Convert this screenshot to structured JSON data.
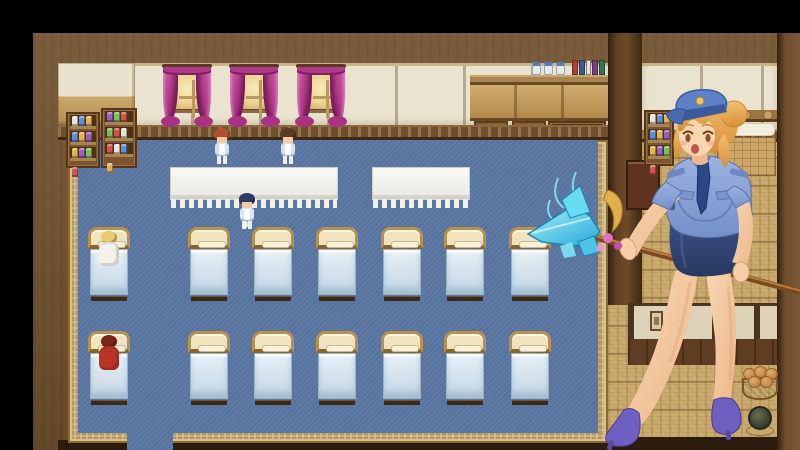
{
  "scene": {
    "title": "dormitory-interior-game-scene",
    "palette": {
      "carpet": "#5a76a2",
      "carpet_border": "#b7985c",
      "tatami": "#c9a96b",
      "curtain": "#c6429c",
      "wall_cream": "#eae3cf",
      "wall_frame": "#71512e",
      "bed_frame": "#b8914f",
      "mattress": "#dcebf4",
      "crystal": "#49cdec",
      "uniform_blue": "#8ca6d8",
      "skirt_navy": "#2e4070",
      "hair_blonde": "#eaaa55"
    },
    "main_room": {
      "windows_x": [
        165,
        232,
        299
      ],
      "tables": [
        {
          "x": 170,
          "y": 167,
          "w": 168,
          "h": 33
        },
        {
          "x": 372,
          "y": 167,
          "w": 98,
          "h": 33
        }
      ],
      "beds": {
        "columns_x": [
          88,
          188,
          252,
          316,
          381,
          444,
          509
        ],
        "rows_y": [
          227,
          331
        ],
        "width": 42,
        "height": 74
      },
      "potion_colors": [
        "#7ac05e",
        "#d6524a",
        "#e8e4da",
        "#5e8ed6",
        "#e0b450",
        "#9a5ec0"
      ],
      "book_colors": [
        "#b04038",
        "#3a5a9e",
        "#e8e0d0",
        "#7a3a8e",
        "#2e7a4e"
      ],
      "sprites": [
        {
          "name": "nurse-auburn-sprite",
          "x": 213,
          "y": 127,
          "hair": "#b5502e",
          "outfit": "#cfe4ef"
        },
        {
          "name": "nurse-brunette-sprite",
          "x": 279,
          "y": 127,
          "hair": "#5a3a24",
          "outfit": "#cfe4ef"
        },
        {
          "name": "attendant-navy-hair-sprite",
          "x": 238,
          "y": 192,
          "hair": "#2e3a66",
          "outfit": "#dbe9f2"
        }
      ],
      "patients": [
        {
          "name": "patient-blonde-sprite",
          "row": 0,
          "col": 0,
          "hair": "#ecc870",
          "gown": "#f3f1ea"
        },
        {
          "name": "patient-red-sprite",
          "row": 1,
          "col": 0,
          "hair": "#7a2418",
          "gown": "#bb3326"
        }
      ]
    },
    "right_room": {
      "window_x": 672,
      "basket_bread_positions": [
        [
          1,
          2
        ],
        [
          12,
          0
        ],
        [
          23,
          2
        ],
        [
          6,
          10
        ],
        [
          18,
          10
        ]
      ]
    },
    "character": {
      "name": "police-uniform-woman",
      "weapon": "crystal-spear"
    }
  }
}
